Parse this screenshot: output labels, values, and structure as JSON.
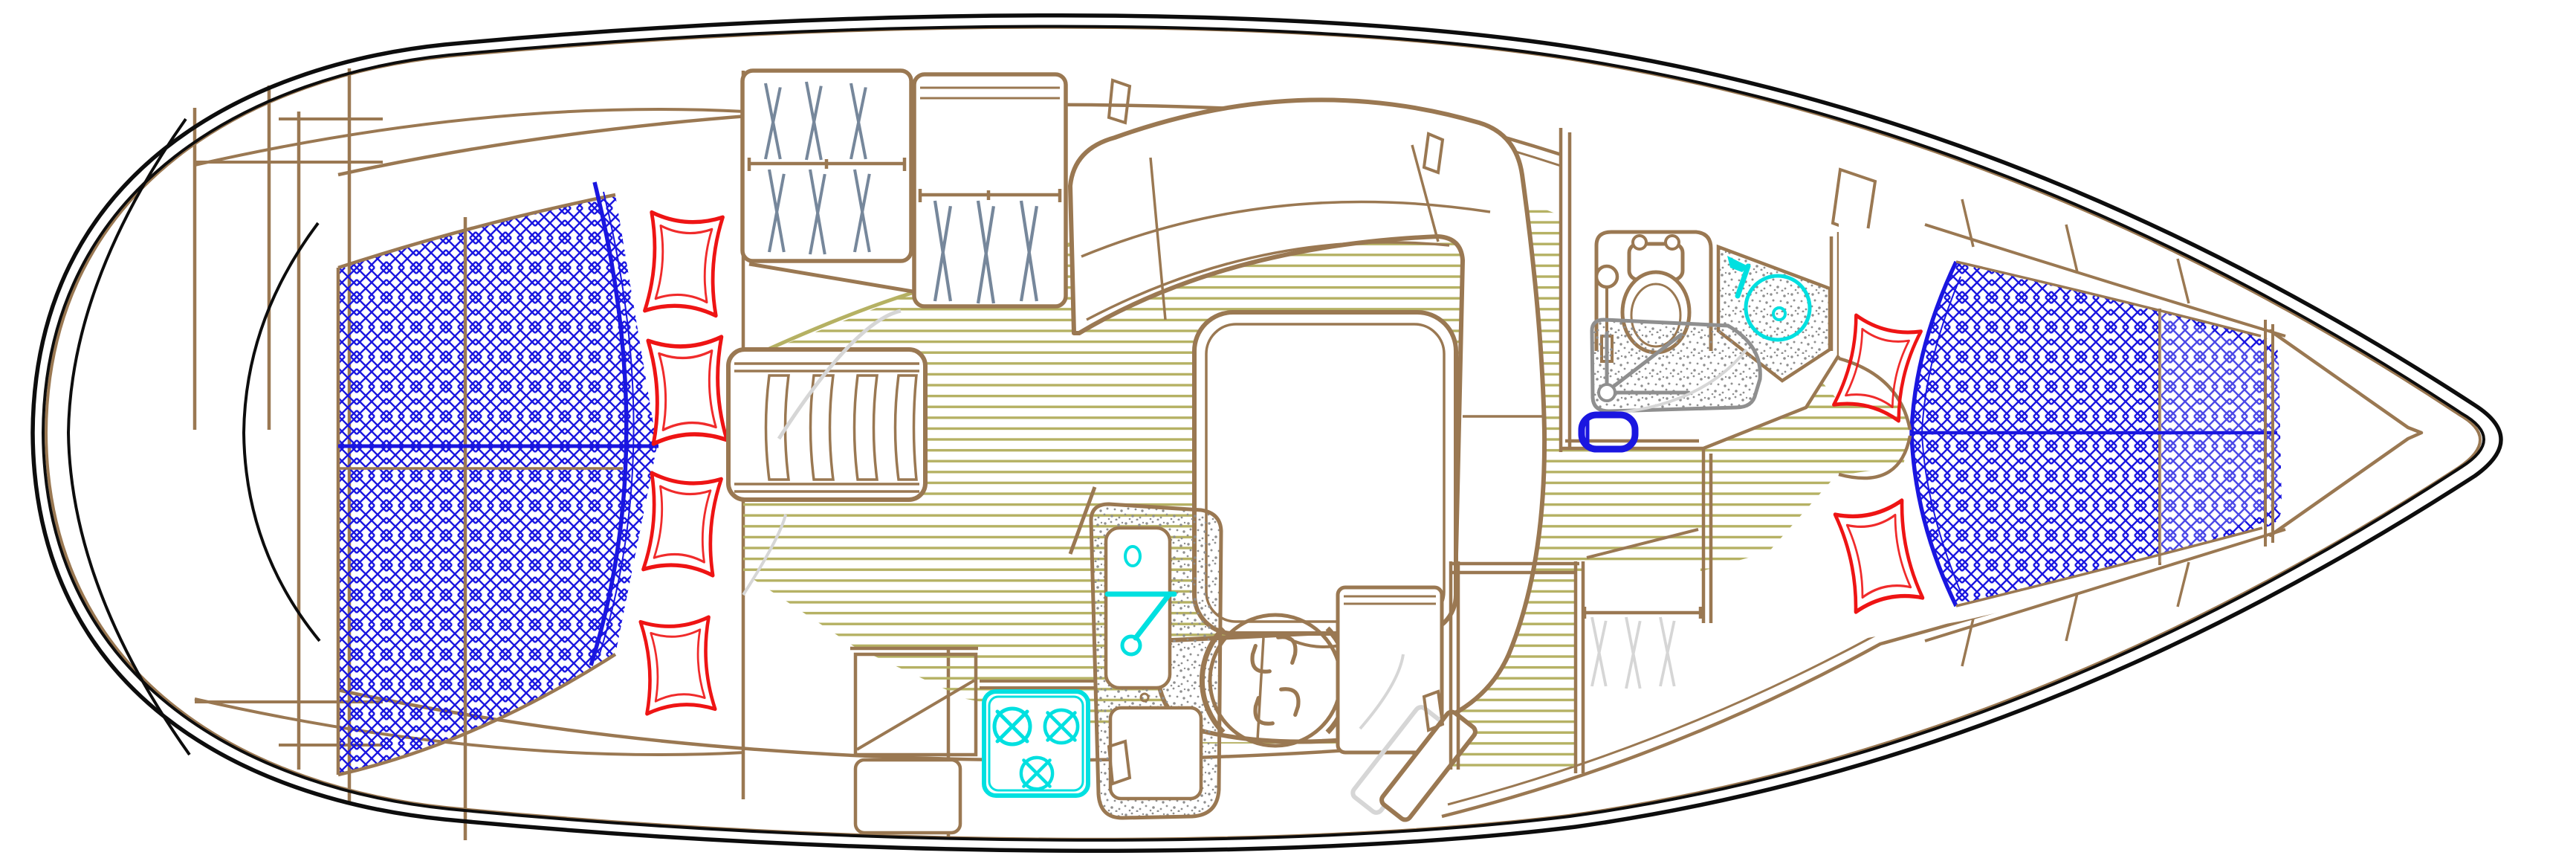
{
  "drawing": {
    "kind": "sailboat-interior-floorplan",
    "orientation": "bow-right-stern-left"
  },
  "colors": {
    "black": "#0d0d0d",
    "brown": "#9a7852",
    "blue": "#1a16e0",
    "red": "#ee1414",
    "cyan": "#00e0e0",
    "olive": "#b5b163",
    "gray": "#8f8f8f",
    "palegray": "#d6d6d6",
    "slate": "#76879b",
    "white": "#ffffff"
  },
  "fixtures": {
    "hull": "hull-outline",
    "stern_platform": "stern-swim-platform-arcs",
    "aft_bed": "aft-cabin-double-berth-mattress",
    "aft_pillows": "aft-cabin-pillows",
    "wardrobe_port": "hanging-locker-with-hangers",
    "wardrobe_port2": "hanging-locker-2-with-hangers",
    "slat_seat": "slatted-bench-seat",
    "cabin_sole": "cabin-sole-plank-floor",
    "settee": "u-shaped-salon-settee",
    "table": "salon-table",
    "galley_counter": "galley-counter",
    "stove": "three-burner-stove",
    "galley_sink": "galley-sink-island-with-faucet",
    "nav_stool": "navigator-swivel-stool",
    "nav_desk": "chart-table-desk",
    "steps": "companionway-steps",
    "locker_aft_stbd": "aft-starboard-hanging-locker",
    "head_room": "head-compartment",
    "toilet": "marine-toilet",
    "head_sink": "head-washbasin-with-faucet",
    "shower": "shower-pan-with-drain",
    "foot_pump": "shower-foot-tub",
    "vberth": "bow-v-berth-mattress",
    "vberth_pillows": "v-berth-pillows",
    "anchor_locker": "anchor-locker-chevrons",
    "door_arcs": "door-swing-arcs",
    "hull_windows": "hull-window-ticks"
  }
}
